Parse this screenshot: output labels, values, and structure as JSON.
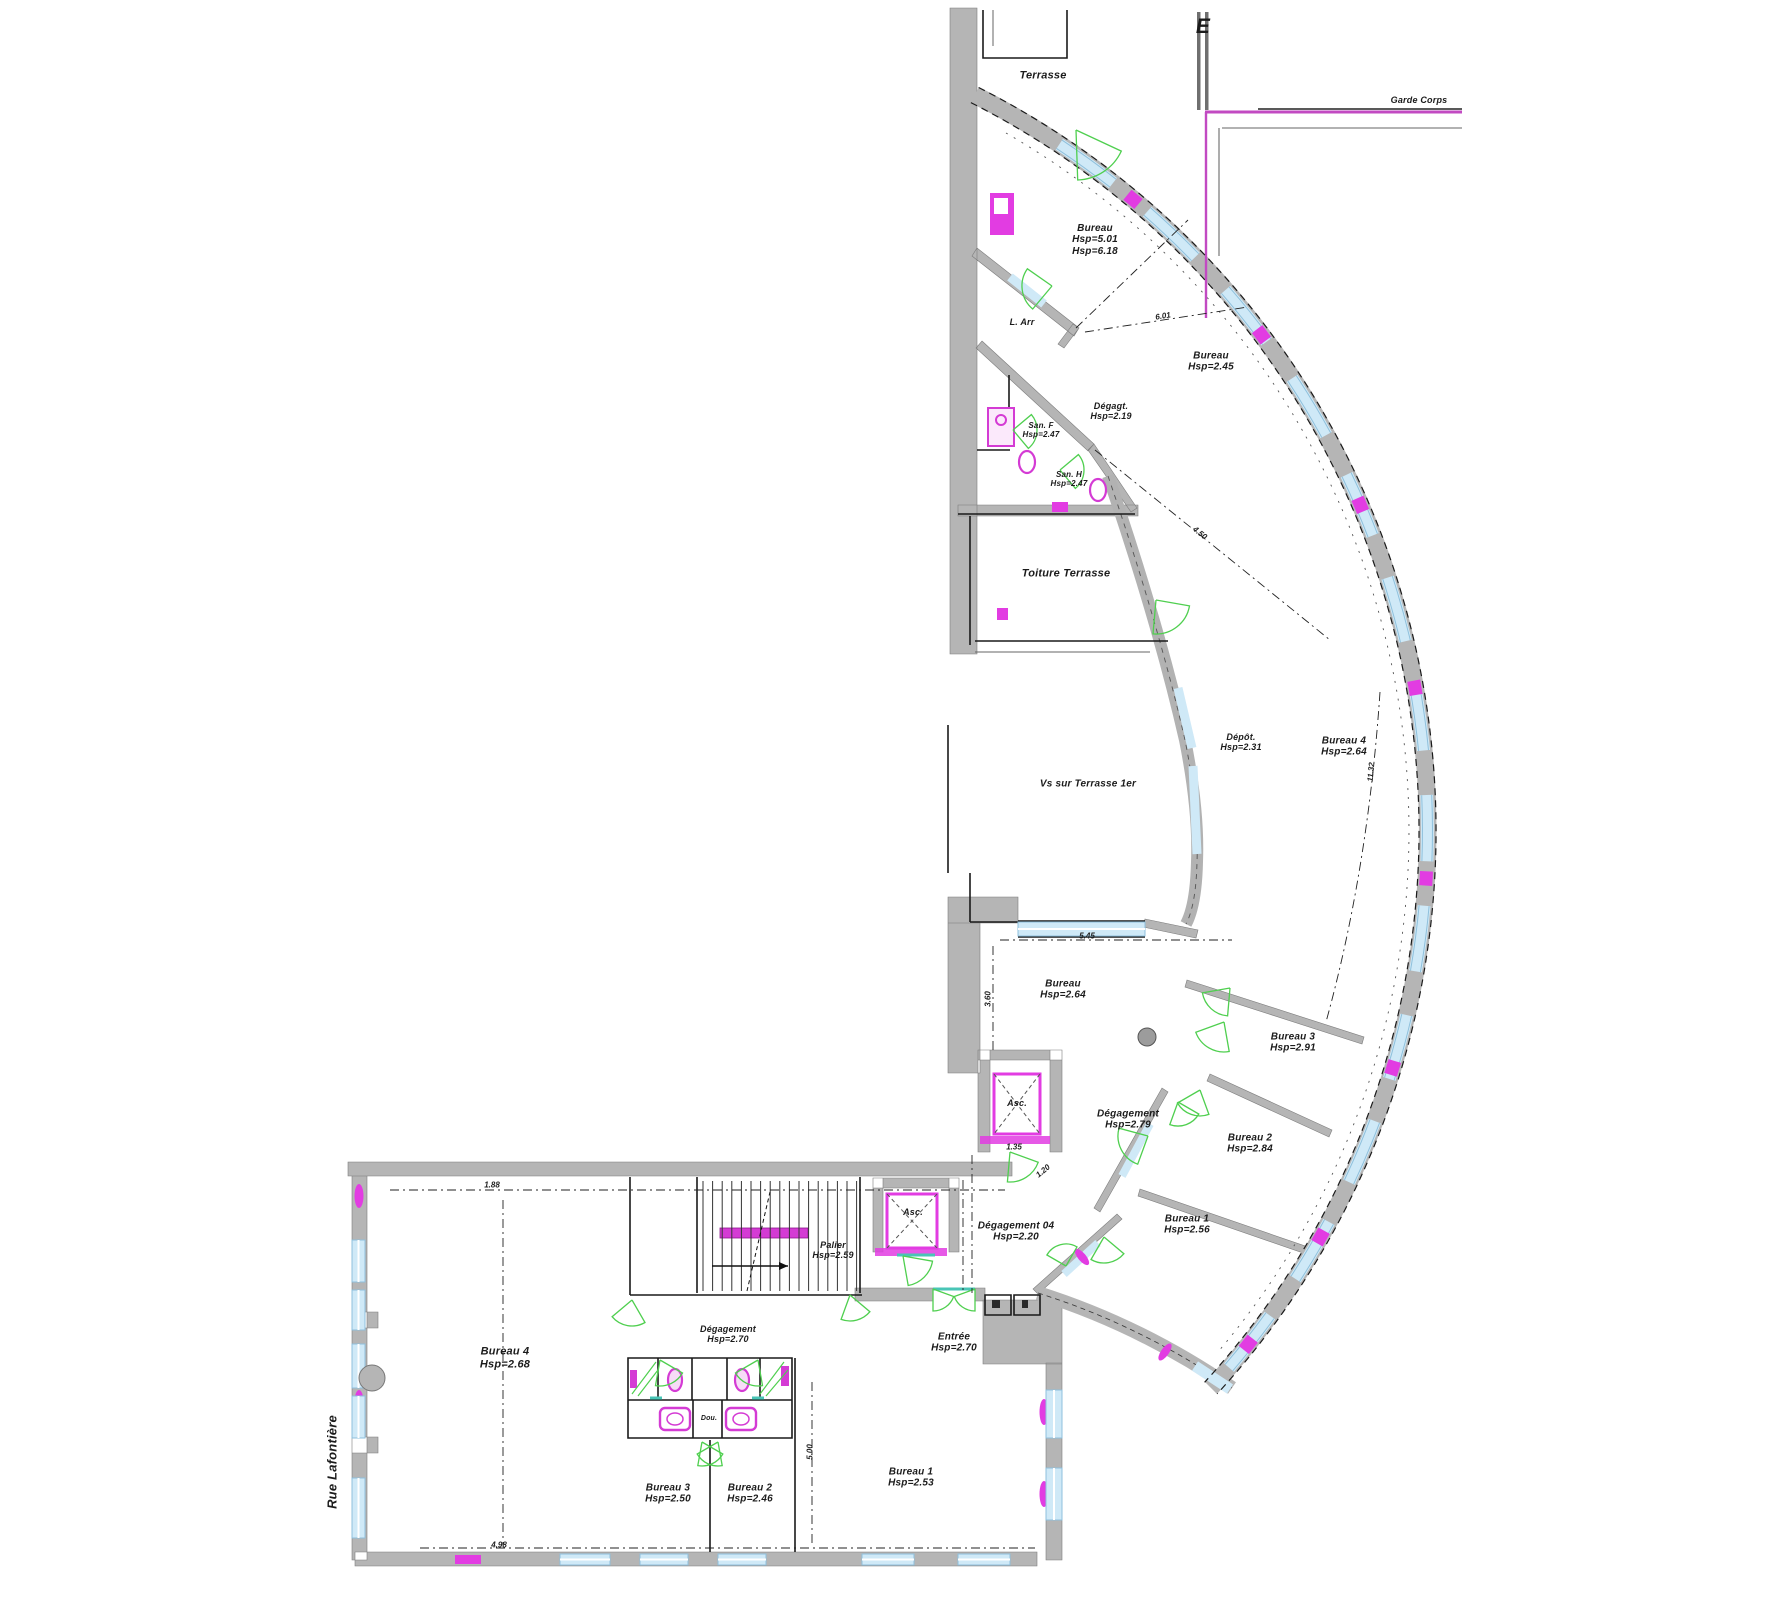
{
  "drawing": {
    "kind": "architectural-floor-plan",
    "background": "#ffffff"
  },
  "colors": {
    "wall_gray": "#b5b5b5",
    "wall_edge": "#7d7d7d",
    "line_black": "#1a1a1a",
    "glazing_fill": "#cfe9f7",
    "glazing_edge": "#8fc0dc",
    "fixture_magenta": "#e23ce2",
    "rail_magenta": "#d43bd4",
    "door_green": "#4fcf4f",
    "sill_teal": "#49c5b6"
  },
  "labels": [
    {
      "id": "terrasse",
      "lines": [
        "Terrasse"
      ],
      "x": 1043,
      "y": 76,
      "size": 11
    },
    {
      "id": "garde-corps",
      "lines": [
        "Garde  Corps"
      ],
      "x": 1419,
      "y": 100,
      "size": 9
    },
    {
      "id": "electrical-symbol",
      "lines": [
        "E"
      ],
      "x": 1203,
      "y": 27,
      "size": 21
    },
    {
      "id": "bureau-haut",
      "lines": [
        "Bureau",
        "Hsp=5.01",
        "Hsp=6.18"
      ],
      "x": 1095,
      "y": 240,
      "size": 10
    },
    {
      "id": "l-arr",
      "lines": [
        "L. Arr"
      ],
      "x": 1022,
      "y": 322,
      "size": 9
    },
    {
      "id": "bureau-245",
      "lines": [
        "Bureau",
        "Hsp=2.45"
      ],
      "x": 1211,
      "y": 362,
      "size": 10
    },
    {
      "id": "degagt",
      "lines": [
        "Dégagt.",
        "Hsp=2.19"
      ],
      "x": 1111,
      "y": 411,
      "size": 9
    },
    {
      "id": "san-f",
      "lines": [
        "San. F",
        "Hsp=2.47"
      ],
      "x": 1041,
      "y": 430,
      "size": 8
    },
    {
      "id": "san-h",
      "lines": [
        "San. H",
        "Hsp=2.47"
      ],
      "x": 1069,
      "y": 479,
      "size": 8
    },
    {
      "id": "toiture-terrasse",
      "lines": [
        "Toiture  Terrasse"
      ],
      "x": 1066,
      "y": 574,
      "size": 11
    },
    {
      "id": "vs-terrasse",
      "lines": [
        "Vs  sur  Terrasse  1er"
      ],
      "x": 1088,
      "y": 784,
      "size": 10
    },
    {
      "id": "depot",
      "lines": [
        "Dépôt.",
        "Hsp=2.31"
      ],
      "x": 1241,
      "y": 742,
      "size": 9
    },
    {
      "id": "bureau4-arc",
      "lines": [
        "Bureau 4",
        "Hsp=2.64"
      ],
      "x": 1344,
      "y": 747,
      "size": 10
    },
    {
      "id": "bureau-264",
      "lines": [
        "Bureau",
        "Hsp=2.64"
      ],
      "x": 1063,
      "y": 990,
      "size": 10
    },
    {
      "id": "asc-1",
      "lines": [
        "Asc."
      ],
      "x": 1017,
      "y": 1103,
      "size": 9
    },
    {
      "id": "degagement-279",
      "lines": [
        "Dégagement",
        "Hsp=2.79"
      ],
      "x": 1128,
      "y": 1120,
      "size": 10
    },
    {
      "id": "bureau3-arc",
      "lines": [
        "Bureau 3",
        "Hsp=2.91"
      ],
      "x": 1293,
      "y": 1043,
      "size": 10
    },
    {
      "id": "bureau2-arc",
      "lines": [
        "Bureau 2",
        "Hsp=2.84"
      ],
      "x": 1250,
      "y": 1144,
      "size": 10
    },
    {
      "id": "bureau1-arc",
      "lines": [
        "Bureau 1",
        "Hsp=2.56"
      ],
      "x": 1187,
      "y": 1225,
      "size": 10
    },
    {
      "id": "degagement-04",
      "lines": [
        "Dégagement 04",
        "Hsp=2.20"
      ],
      "x": 1016,
      "y": 1232,
      "size": 10
    },
    {
      "id": "asc-2",
      "lines": [
        "Asc."
      ],
      "x": 913,
      "y": 1212,
      "size": 9
    },
    {
      "id": "palier",
      "lines": [
        "Palier",
        "Hsp=2.59"
      ],
      "x": 833,
      "y": 1250,
      "size": 9
    },
    {
      "id": "entree",
      "lines": [
        "Entrée",
        "Hsp=2.70"
      ],
      "x": 954,
      "y": 1343,
      "size": 10
    },
    {
      "id": "degagement-270",
      "lines": [
        "Dégagement",
        "Hsp=2.70"
      ],
      "x": 728,
      "y": 1334,
      "size": 9
    },
    {
      "id": "bureau4-main",
      "lines": [
        "Bureau 4",
        "Hsp=2.68"
      ],
      "x": 505,
      "y": 1358,
      "size": 11
    },
    {
      "id": "bureau3-main",
      "lines": [
        "Bureau 3",
        "Hsp=2.50"
      ],
      "x": 668,
      "y": 1494,
      "size": 10
    },
    {
      "id": "bureau2-main",
      "lines": [
        "Bureau 2",
        "Hsp=2.46"
      ],
      "x": 750,
      "y": 1494,
      "size": 10
    },
    {
      "id": "bureau1-main",
      "lines": [
        "Bureau 1",
        "Hsp=2.53"
      ],
      "x": 911,
      "y": 1478,
      "size": 10
    },
    {
      "id": "rue-lafontiere",
      "lines": [
        "Rue   Lafontière"
      ],
      "x": 333,
      "y": 1462,
      "rot": -90,
      "size": 13
    },
    {
      "id": "douche",
      "lines": [
        "Dou."
      ],
      "x": 709,
      "y": 1419,
      "size": 7
    }
  ],
  "dimensions": [
    {
      "text": "1.88",
      "x": 492,
      "y": 1185
    },
    {
      "text": "4.98",
      "x": 499,
      "y": 1545
    },
    {
      "text": "5.45",
      "x": 1087,
      "y": 936
    },
    {
      "text": "3.60",
      "x": 988,
      "y": 999,
      "rot": -90
    },
    {
      "text": "1.35",
      "x": 1014,
      "y": 1147
    },
    {
      "text": "1.20",
      "x": 1043,
      "y": 1171,
      "rot": -40
    },
    {
      "text": "11.32",
      "x": 1371,
      "y": 772,
      "rot": -85
    },
    {
      "text": "6.01",
      "x": 1163,
      "y": 316,
      "rot": -9
    },
    {
      "text": "4.50",
      "x": 1200,
      "y": 533,
      "rot": 39
    },
    {
      "text": "5.00",
      "x": 810,
      "y": 1452,
      "rot": -90
    }
  ]
}
